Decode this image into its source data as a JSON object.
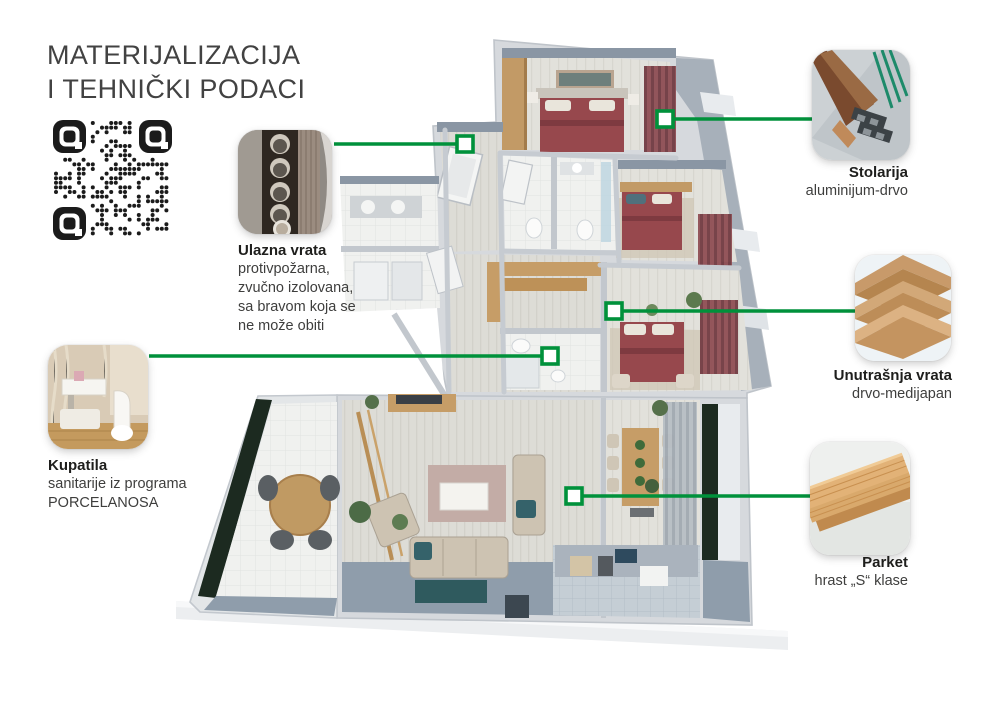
{
  "title": {
    "line1": "MATERIJALIZACIJA",
    "line2": "I TEHNIČKI PODACI"
  },
  "accent_color": "#00913B",
  "qr": {
    "icon": "qr-code"
  },
  "callouts": {
    "ulazna_vrata": {
      "title": "Ulazna vrata",
      "lines": [
        "protivpožarna,",
        "zvučno izolovana,",
        "sa bravom koja se",
        "ne može obiti"
      ],
      "image": "entrance-door-lock-photo"
    },
    "stolarija": {
      "title": "Stolarija",
      "lines": [
        "aluminijum-drvo"
      ],
      "image": "aluminum-wood-window-profile-photo"
    },
    "unutrasnja_vrata": {
      "title": "Unutrašnja vrata",
      "lines": [
        "drvo-medijapan"
      ],
      "image": "mdf-board-stack-photo"
    },
    "kupatila": {
      "title": "Kupatila",
      "lines": [
        "sanitarije iz programa",
        "PORCELANOSA"
      ],
      "image": "bathroom-sanitary-photo"
    },
    "parket": {
      "title": "Parket",
      "lines": [
        "hrast „S“ klase"
      ],
      "image": "oak-parquet-planks-photo"
    }
  }
}
